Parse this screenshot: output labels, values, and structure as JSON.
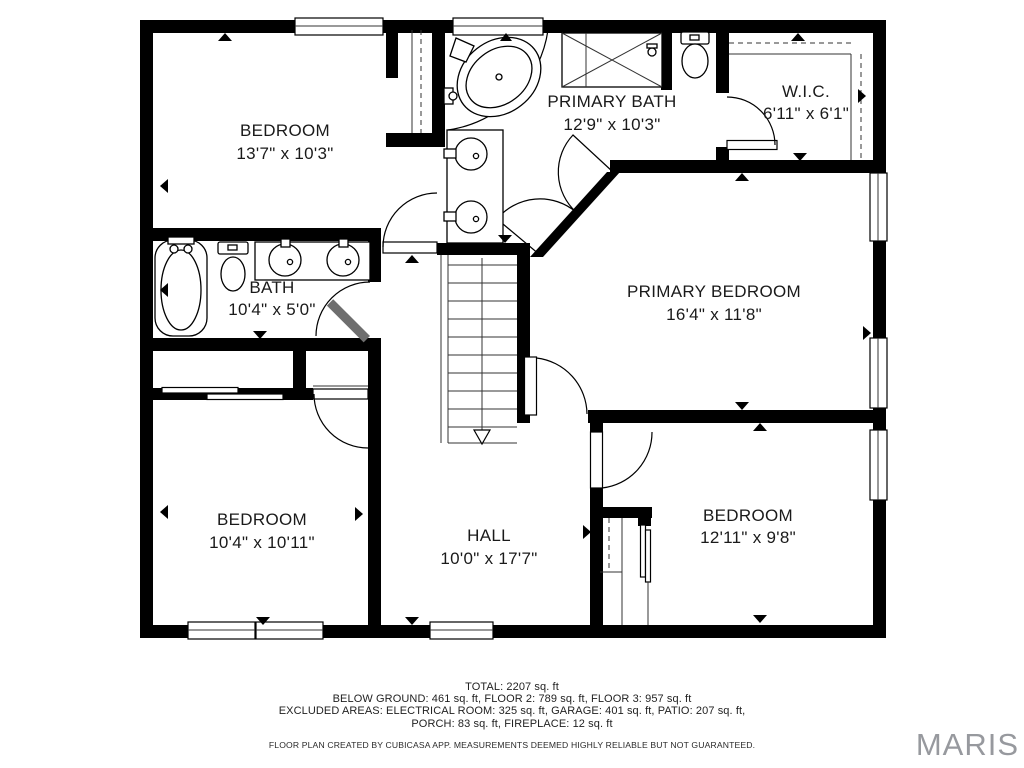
{
  "plan": {
    "rooms": [
      {
        "id": "bedroom-top-left",
        "name": "BEDROOM",
        "dims": "13'7\" x 10'3\""
      },
      {
        "id": "primary-bath",
        "name": "PRIMARY BATH",
        "dims": "12'9\" x 10'3\""
      },
      {
        "id": "walk-in-closet",
        "name": "W.I.C.",
        "dims": "6'11\" x 6'1\""
      },
      {
        "id": "bath",
        "name": "BATH",
        "dims": "10'4\" x 5'0\""
      },
      {
        "id": "primary-bedroom",
        "name": "PRIMARY BEDROOM",
        "dims": "16'4\" x 11'8\""
      },
      {
        "id": "bedroom-bottom-left",
        "name": "BEDROOM",
        "dims": "10'4\" x 10'11\""
      },
      {
        "id": "hall",
        "name": "HALL",
        "dims": "10'0\" x 17'7\""
      },
      {
        "id": "bedroom-bottom-right",
        "name": "BEDROOM",
        "dims": "12'11\" x 9'8\""
      }
    ],
    "summary": {
      "line1": "TOTAL: 2207 sq. ft",
      "line2": "BELOW GROUND: 461 sq. ft, FLOOR 2: 789 sq. ft, FLOOR 3: 957 sq. ft",
      "line3": "EXCLUDED AREAS: ELECTRICAL ROOM: 325 sq. ft, GARAGE: 401 sq. ft, PATIO: 207 sq. ft,",
      "line4": "PORCH: 83 sq. ft, FIREPLACE: 12 sq. ft",
      "disclaimer": "FLOOR PLAN CREATED BY CUBICASA APP. MEASUREMENTS DEEMED HIGHLY RELIABLE BUT NOT GUARANTEED."
    },
    "watermark": "MARIS",
    "colors": {
      "wall": "#000000",
      "watermark": "#97999e",
      "text": "#1a1a1a"
    }
  }
}
